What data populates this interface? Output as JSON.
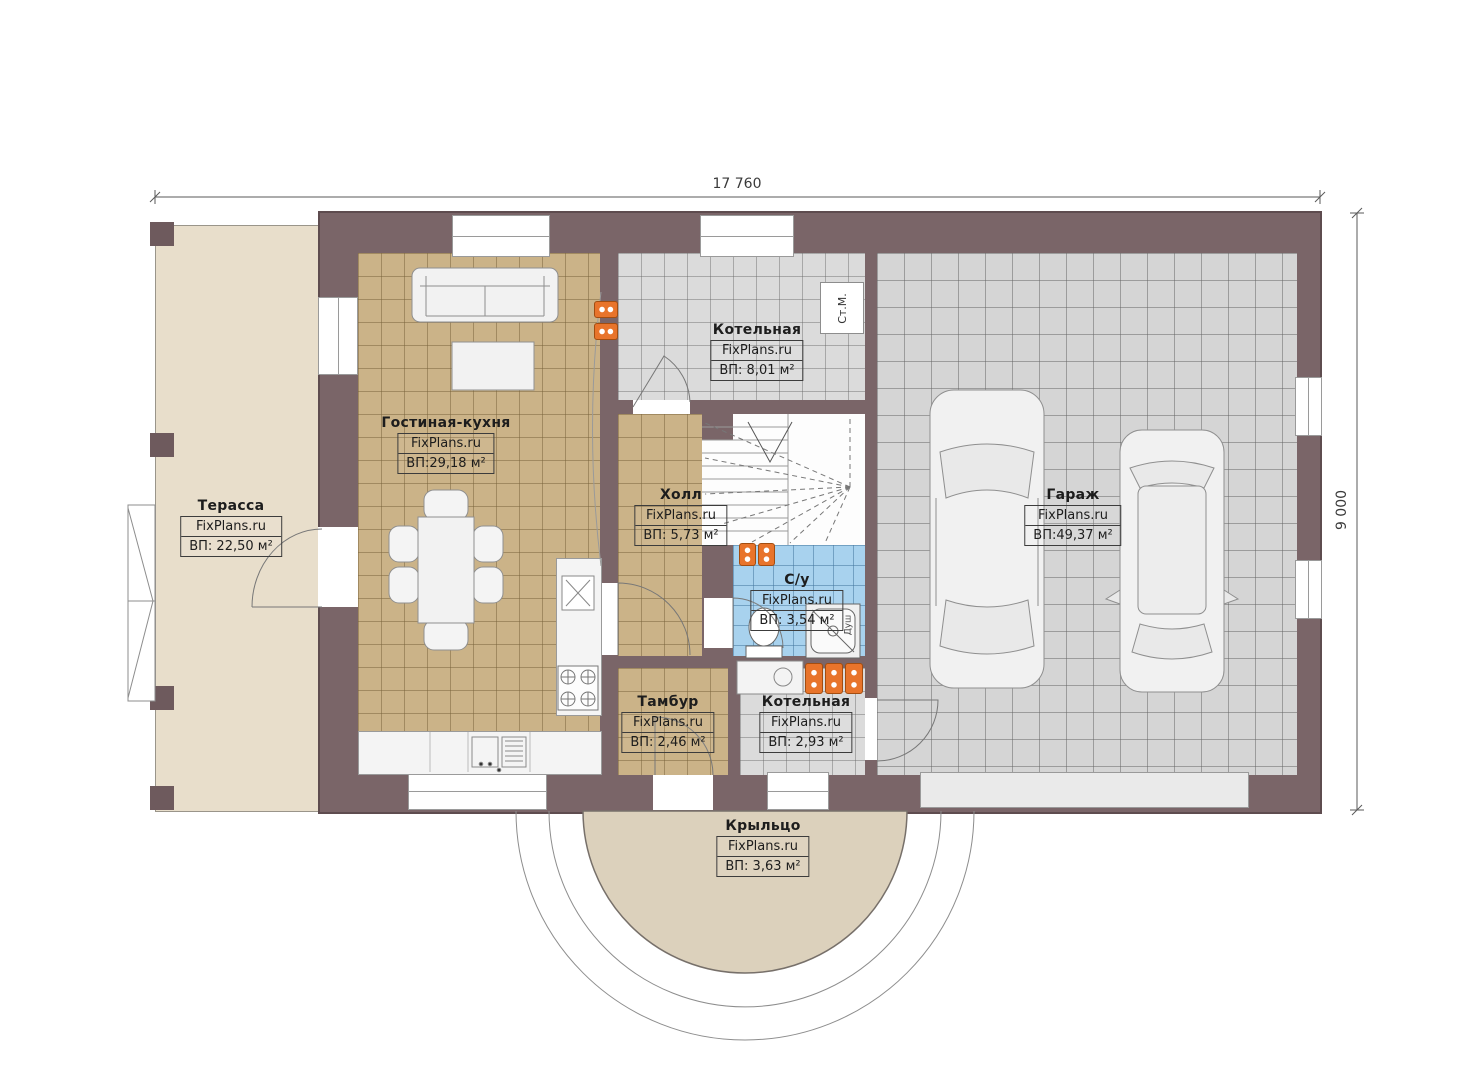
{
  "plan_title": "First floor plan",
  "dimensions": {
    "width_label": "17 760",
    "height_label": "9 000"
  },
  "rooms": [
    {
      "name": "Терасса",
      "brand": "FixPlans.ru",
      "area": "ВП: 22,50 м²"
    },
    {
      "name": "Гостиная-кухня",
      "brand": "FixPlans.ru",
      "area": "ВП:29,18 м²"
    },
    {
      "name": "Котельная",
      "brand": "FixPlans.ru",
      "area": "ВП: 8,01 м²"
    },
    {
      "name": "Холл",
      "brand": "FixPlans.ru",
      "area": "ВП: 5,73 м²"
    },
    {
      "name": "Гараж",
      "brand": "FixPlans.ru",
      "area": "ВП:49,37 м²"
    },
    {
      "name": "С/у",
      "brand": "FixPlans.ru",
      "area": "ВП: 3,54 м²"
    },
    {
      "name": "Тамбур",
      "brand": "FixPlans.ru",
      "area": "ВП: 2,46 м²"
    },
    {
      "name": "Котельная",
      "brand": "FixPlans.ru",
      "area": "ВП: 2,93 м²"
    },
    {
      "name": "Крыльцо",
      "brand": "FixPlans.ru",
      "area": "ВП: 3,63 м²"
    }
  ],
  "annotations": {
    "washing_machine": "Ст.М.",
    "shower": "Душ"
  },
  "colors": {
    "wall": "#7a6568",
    "terrace_fill": "#e8decb",
    "porch_fill": "#dcd1bc",
    "living_tile": "#cbb388",
    "utility_tile": "#dbdbdb",
    "garage_tile": "#d5d5d5",
    "bathroom_tile": "#a8d2ee",
    "radiator": "#e8742b"
  }
}
